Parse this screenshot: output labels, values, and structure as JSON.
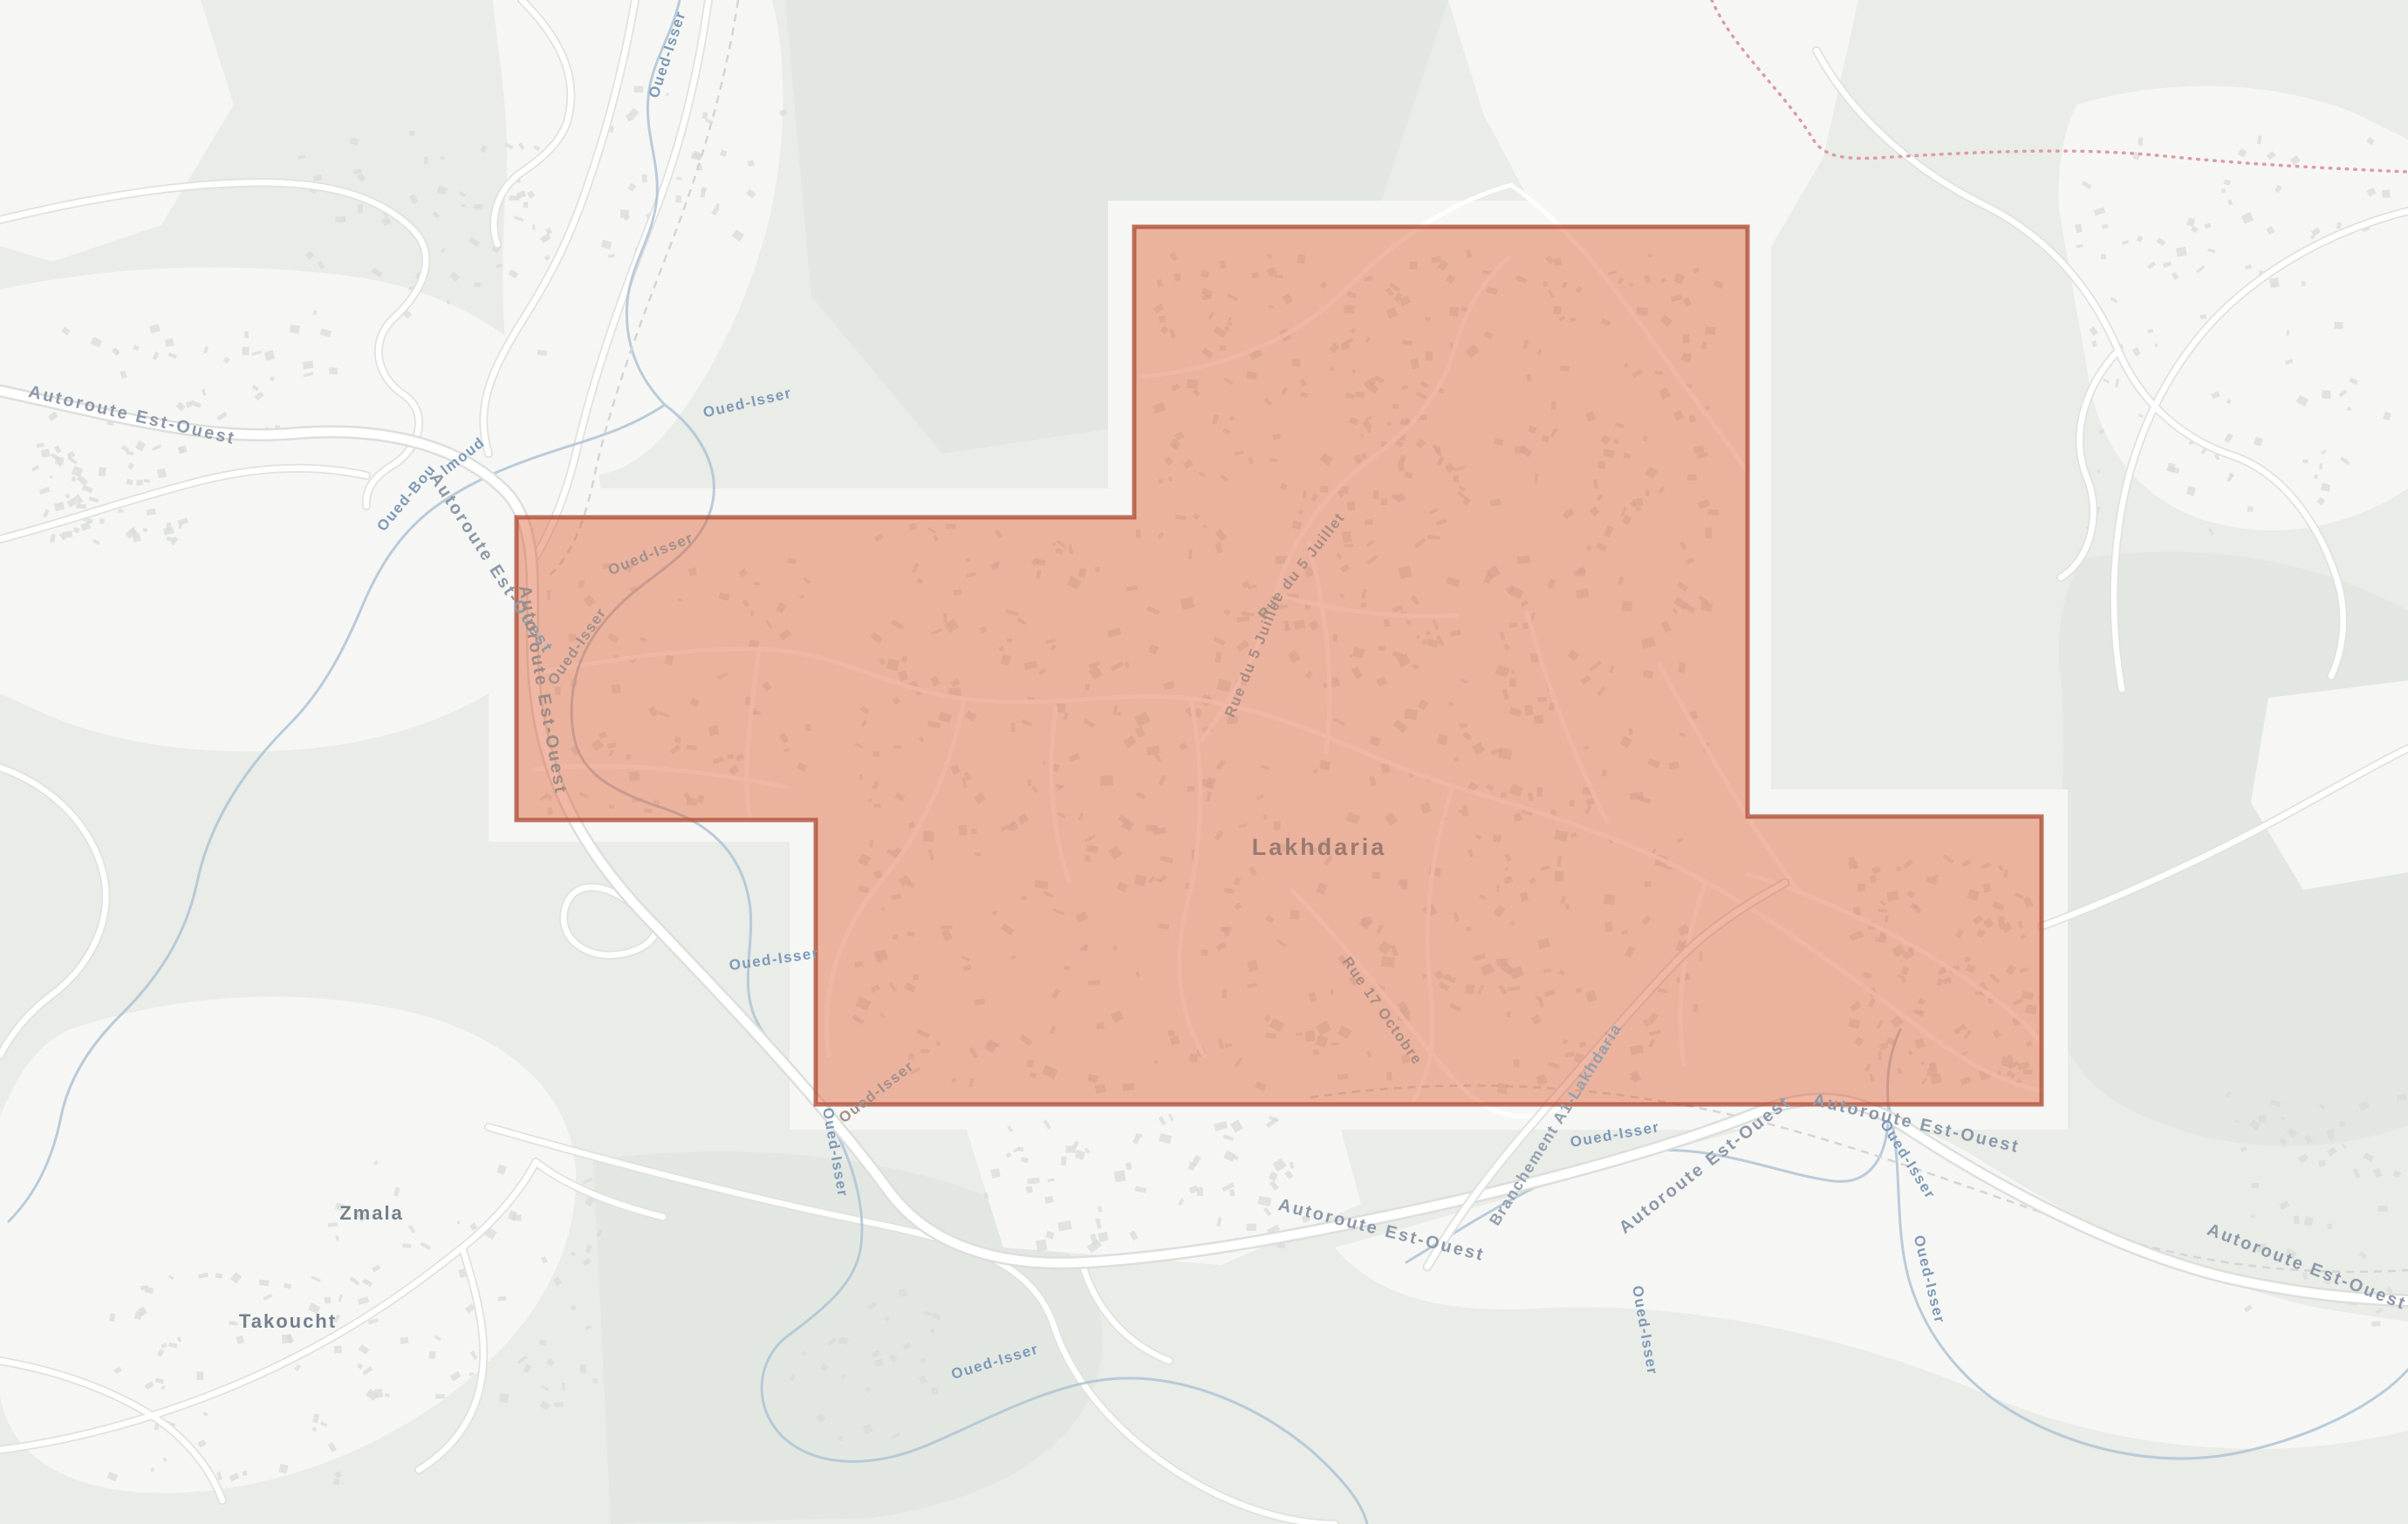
{
  "map": {
    "city_label": "Lakhdaria",
    "village_labels": {
      "zmala": "Zmala",
      "takoucht": "Takoucht"
    },
    "road_labels": {
      "autoroute": "Autoroute Est-Ouest",
      "rue_du_5_juillet": "Rue du 5 Juillet",
      "rue_17_octobre": "Rue 17 Octobre",
      "branchement": "Branchement A1-Lakhdaria"
    },
    "river_labels": {
      "oued_isser": "Oued-Isser",
      "oued_bou_fragment_start": "Oued-Bou",
      "oued_bou_fragment_end": "lmoud"
    },
    "overlay": {
      "fill": "#dd5f35",
      "fill_opacity": "0.45",
      "stroke": "#b0503a"
    },
    "colors": {
      "admin_boundary": "#dd9ca6",
      "water": "#afc3d4",
      "land_white": "#f6f7f4",
      "land_green": "#e9ece7",
      "forest_green": "#e2e8e1"
    }
  }
}
